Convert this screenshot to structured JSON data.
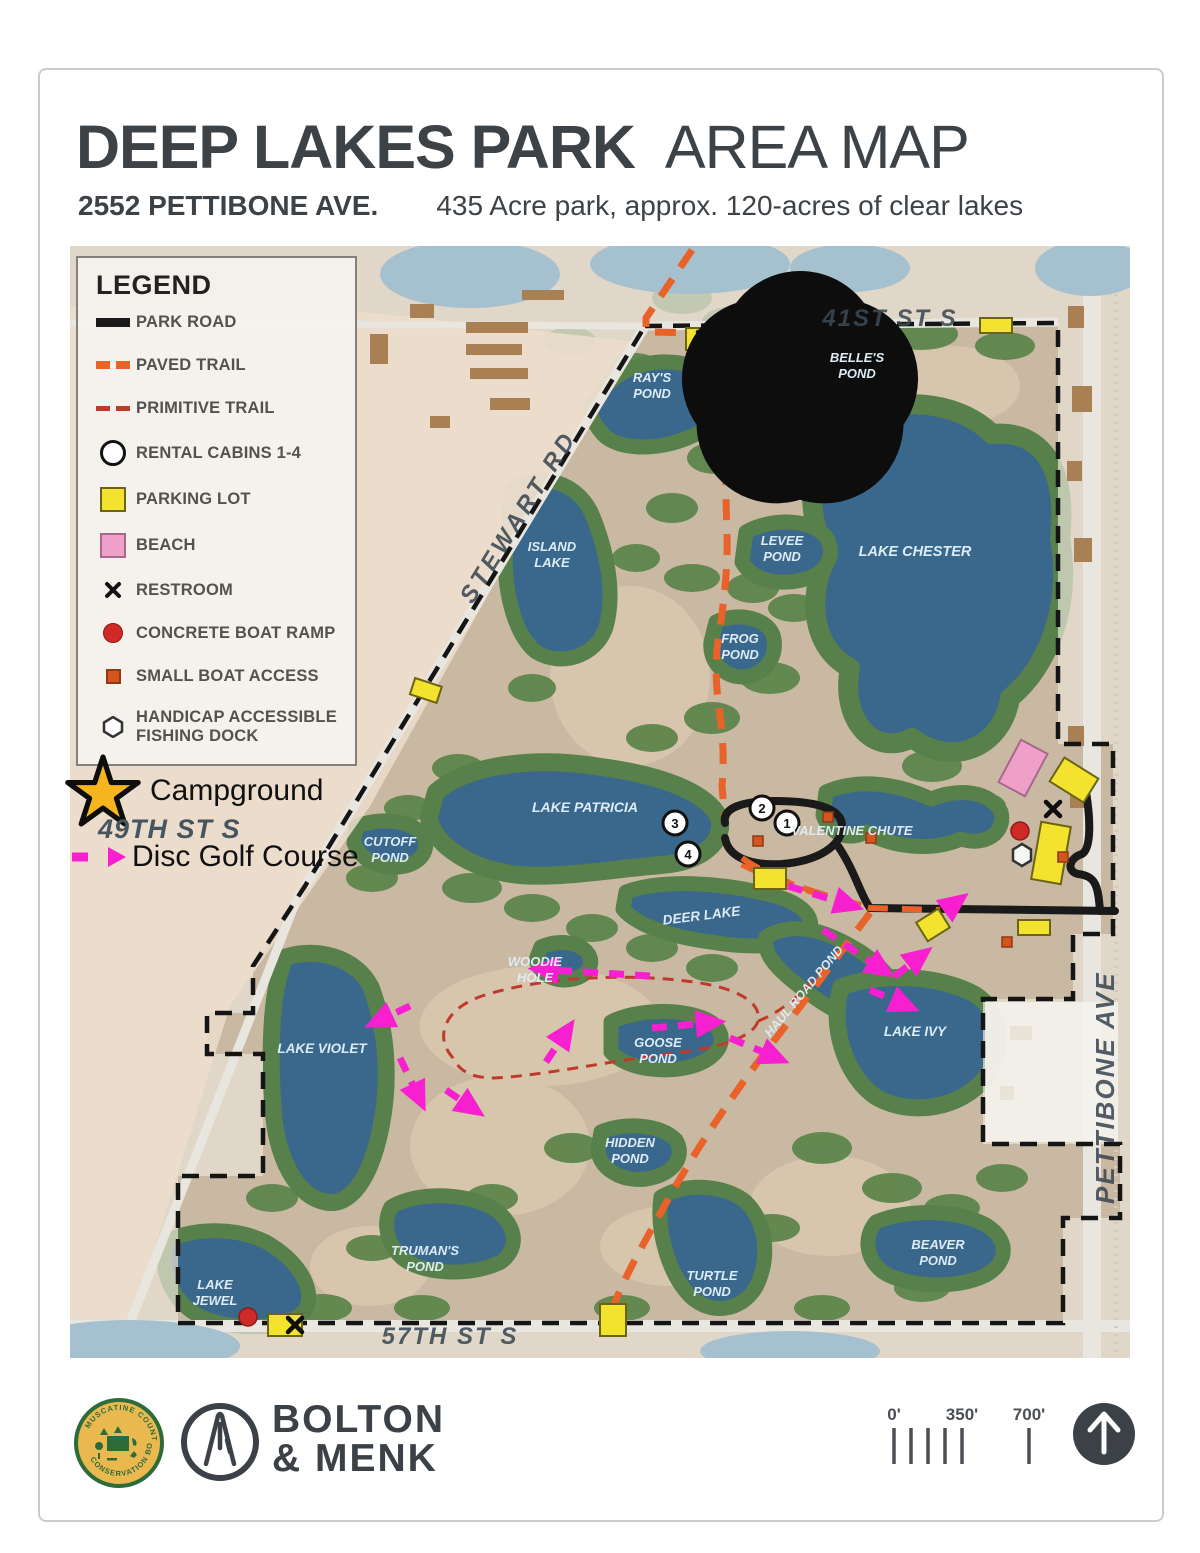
{
  "header": {
    "title_bold": "DEEP LAKES PARK",
    "title_light": "AREA MAP",
    "address": "2552 PETTIBONE AVE.",
    "description": "435 Acre park, approx. 120-acres of clear lakes"
  },
  "legend": {
    "title": "LEGEND",
    "items": [
      {
        "id": "park-road",
        "label": "PARK ROAD"
      },
      {
        "id": "paved-trail",
        "label": "PAVED TRAIL"
      },
      {
        "id": "primitive-trail",
        "label": "PRIMITIVE TRAIL"
      },
      {
        "id": "rental-cabins",
        "label": "RENTAL CABINS 1-4"
      },
      {
        "id": "parking-lot",
        "label": "PARKING LOT"
      },
      {
        "id": "beach",
        "label": "BEACH"
      },
      {
        "id": "restroom",
        "label": "RESTROOM"
      },
      {
        "id": "concrete-boat-ramp",
        "label": "CONCRETE BOAT RAMP"
      },
      {
        "id": "small-boat-access",
        "label": "SMALL BOAT ACCESS"
      },
      {
        "id": "handicap-dock",
        "label_line1": "HANDICAP ACCESSIBLE",
        "label_line2": "FISHING DOCK"
      }
    ]
  },
  "annotations": {
    "campground": "Campground",
    "street_49": "49TH ST S",
    "disc_golf": "Disc Golf Course"
  },
  "map": {
    "streets": {
      "s41": "41ST ST S",
      "stewart": "STEWART RD",
      "s57": "57TH ST S",
      "pettibone": "PETTIBONE AVE"
    },
    "lakes": {
      "rays": [
        "RAY'S",
        "POND"
      ],
      "belles": [
        "BELLE'S",
        "POND"
      ],
      "island": [
        "ISLAND",
        "LAKE"
      ],
      "chester": [
        "LAKE CHESTER"
      ],
      "levee": [
        "LEVEE",
        "POND"
      ],
      "frog": [
        "FROG",
        "POND"
      ],
      "patricia": [
        "LAKE PATRICIA"
      ],
      "cutoff": [
        "CUTOFF",
        "POND"
      ],
      "valentine": [
        "VALENTINE CHUTE"
      ],
      "deer": [
        "DEER LAKE"
      ],
      "woodie": [
        "WOODIE",
        "HOLE"
      ],
      "goose": [
        "GOOSE",
        "POND"
      ],
      "haul": [
        "HAUL ROAD POND"
      ],
      "ivy": [
        "LAKE IVY"
      ],
      "violet": [
        "LAKE VIOLET"
      ],
      "hidden": [
        "HIDDEN",
        "POND"
      ],
      "trumans": [
        "TRUMAN'S",
        "POND"
      ],
      "jewel": [
        "LAKE",
        "JEWEL"
      ],
      "turtle": [
        "TURTLE",
        "POND"
      ],
      "beaver": [
        "BEAVER",
        "POND"
      ]
    },
    "cabins": [
      "1",
      "2",
      "3",
      "4"
    ]
  },
  "footer": {
    "conservation_logo": {
      "top": "MUSCATINE COUNTY",
      "bottom": "CONSERVATION BOARD"
    },
    "brand_line1": "BOLTON",
    "brand_line2": "& MENK",
    "scale": {
      "zero": "0'",
      "mid": "350'",
      "far": "700'"
    }
  },
  "colors": {
    "paved_trail": "#E8622A",
    "primitive_trail": "#C03A2B",
    "park_road": "#1A1A1A",
    "parking": "#F4E32E",
    "beach": "#EFA0C8",
    "boat_ramp": "#CF2A27",
    "small_boat": "#D4561E",
    "disc_golf": "#F71FD0",
    "campground_star": "#F5B51E",
    "water": "#3A678C",
    "boundary": "#151515"
  }
}
